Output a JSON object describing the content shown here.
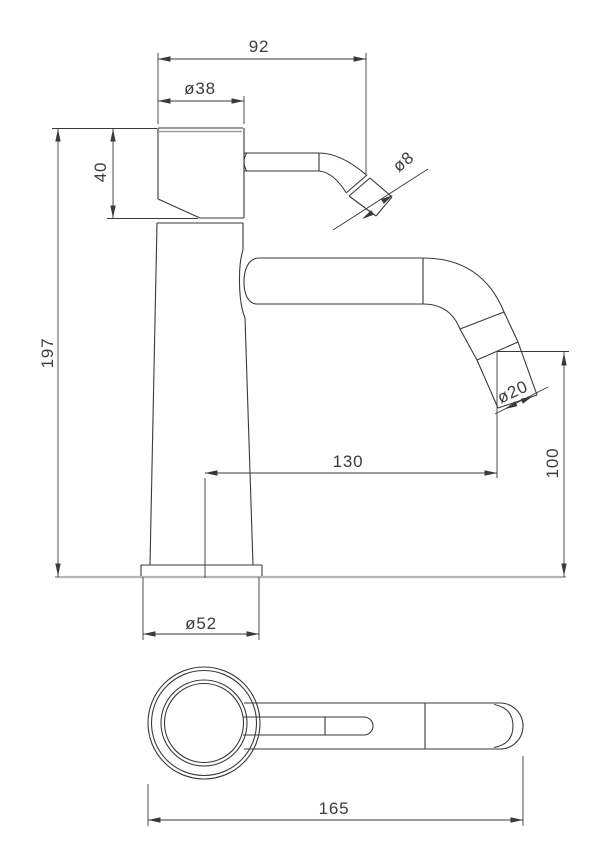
{
  "drawing": {
    "dimensions": {
      "top_width": "92",
      "cap_diameter": "ø38",
      "cap_height": "40",
      "lever_tip_diameter": "ø8",
      "total_height": "197",
      "spout_reach": "130",
      "spout_outlet_height": "100",
      "spout_tip_diameter": "ø20",
      "base_diameter": "ø52",
      "overall_length": "165"
    },
    "colors": {
      "line": "#3a3a3a",
      "surface_line": "#b5b5b5",
      "cap_accent": "#9b9b9b",
      "background": "#ffffff"
    }
  }
}
